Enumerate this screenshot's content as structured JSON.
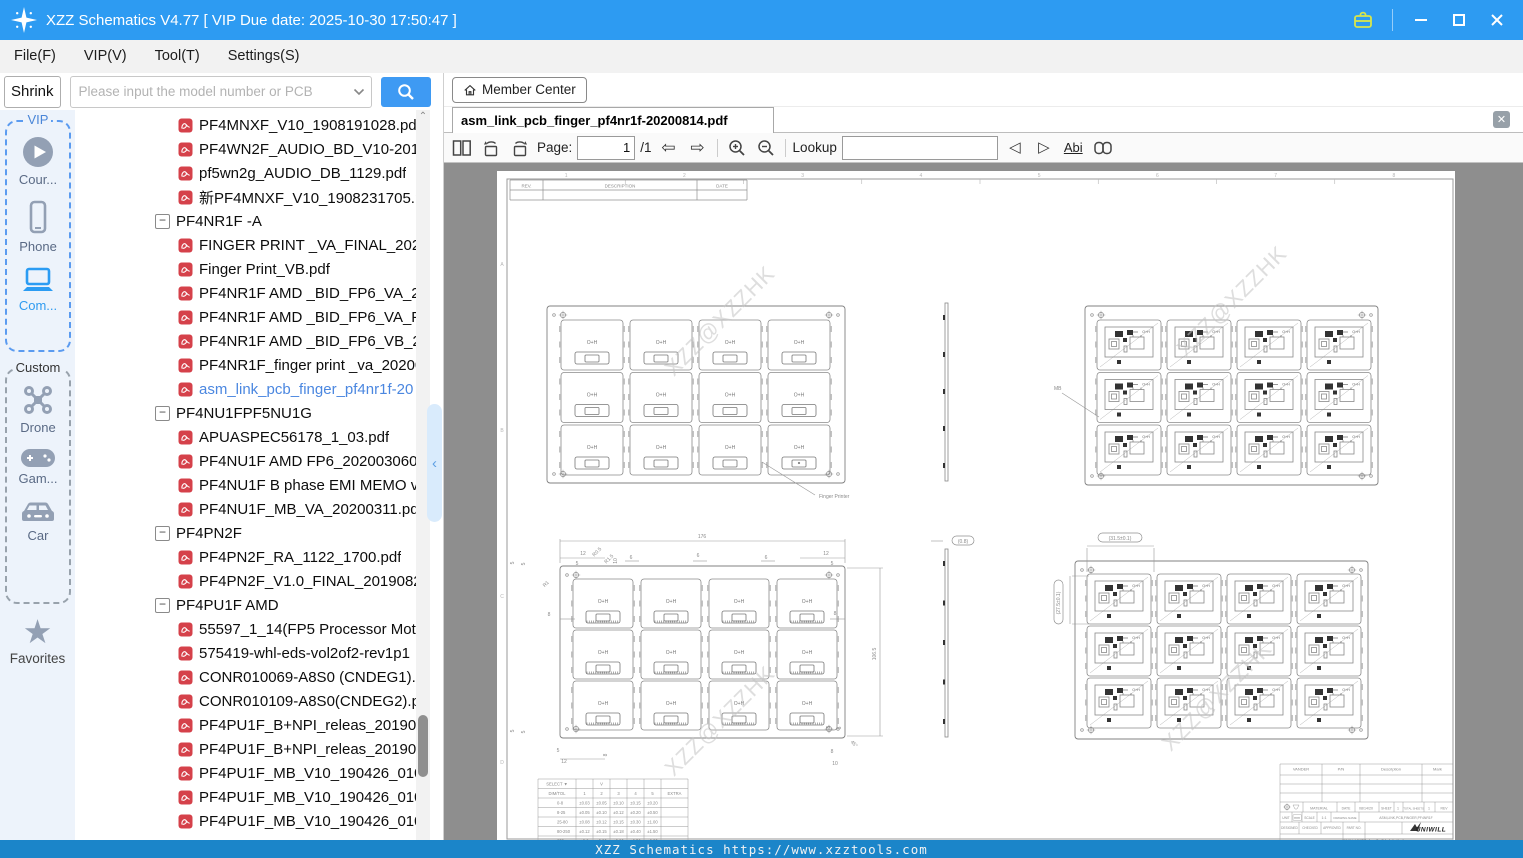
{
  "window": {
    "title": "XZZ Schematics V4.77 [ VIP Due date: 2025-10-30 17:50:47 ]"
  },
  "menu": [
    "File(F)",
    "VIP(V)",
    "Tool(T)",
    "Settings(S)"
  ],
  "search": {
    "shrink": "Shrink",
    "placeholder": "Please input the model number or PCB"
  },
  "member_center": {
    "label": "Member Center"
  },
  "sidebar": {
    "vip_label": "VIP",
    "custom_label": "Custom",
    "favorites_label": "Favorites",
    "items_vip": [
      "Cour...",
      "Phone",
      "Com..."
    ],
    "items_custom": [
      "Drone",
      "Gam...",
      "Car"
    ]
  },
  "tree": [
    {
      "t": "file",
      "l": "PF4MNXF_V10_1908191028.pdf"
    },
    {
      "t": "file",
      "l": "PF4WN2F_AUDIO_BD_V10-2019"
    },
    {
      "t": "file",
      "l": "pf5wn2g_AUDIO_DB_1129.pdf"
    },
    {
      "t": "file",
      "l": "新PF4MNXF_V10_1908231705.pc"
    },
    {
      "t": "folder",
      "l": "PF4NR1F -A"
    },
    {
      "t": "file",
      "l": "FINGER PRINT _VA_FINAL_20200"
    },
    {
      "t": "file",
      "l": "Finger Print_VB.pdf"
    },
    {
      "t": "file",
      "l": "PF4NR1F AMD _BID_FP6_VA_20."
    },
    {
      "t": "file",
      "l": "PF4NR1F AMD _BID_FP6_VA_FIN"
    },
    {
      "t": "file",
      "l": "PF4NR1F AMD _BID_FP6_VB_20."
    },
    {
      "t": "file",
      "l": "PF4NR1F_finger print _va_20200"
    },
    {
      "t": "file",
      "l": "asm_link_pcb_finger_pf4nr1f-20",
      "sel": true
    },
    {
      "t": "folder",
      "l": "PF4NU1FPF5NU1G"
    },
    {
      "t": "file",
      "l": "APUASPEC56178_1_03.pdf"
    },
    {
      "t": "file",
      "l": "PF4NU1F AMD FP6_2020030609"
    },
    {
      "t": "file",
      "l": "PF4NU1F B phase EMI MEMO v."
    },
    {
      "t": "file",
      "l": "PF4NU1F_MB_VA_20200311.pdf"
    },
    {
      "t": "folder",
      "l": "PF4PN2F"
    },
    {
      "t": "file",
      "l": "PF4PN2F_RA_1122_1700.pdf"
    },
    {
      "t": "file",
      "l": "PF4PN2F_V1.0_FINAL_20190828"
    },
    {
      "t": "folder",
      "l": "PF4PU1F AMD"
    },
    {
      "t": "file",
      "l": "55597_1_14(FP5 Processor Moth"
    },
    {
      "t": "file",
      "l": "575419-whl-eds-vol2of2-rev1p1"
    },
    {
      "t": "file",
      "l": "CONR010069-A8S0 (CNDEG1).p"
    },
    {
      "t": "file",
      "l": "CONR010109-A8S0(CNDEG2).pc"
    },
    {
      "t": "file",
      "l": "PF4PU1F_B+NPI_releas_2019062"
    },
    {
      "t": "file",
      "l": "PF4PU1F_B+NPI_releas_2019062"
    },
    {
      "t": "file",
      "l": "PF4PU1F_MB_V10_190426_0102"
    },
    {
      "t": "file",
      "l": "PF4PU1F_MB_V10_190426_0103"
    },
    {
      "t": "file",
      "l": "PF4PU1F_MB_V10_190426_0104"
    }
  ],
  "viewer": {
    "tab": "asm_link_pcb_finger_pf4nr1f-20200814.pdf",
    "page_label": "Page:",
    "page": "1",
    "of": "/1",
    "lookup_label": "Lookup",
    "abi_label": "Abi"
  },
  "status": {
    "text": "XZZ Schematics https://www.xzztools.com"
  },
  "drawing": {
    "watermark": "XZZ@XZZHK",
    "module_mark": "O+H",
    "rev_header": [
      "REV.",
      "DESCRIPTION",
      "DATE"
    ],
    "zone_numbers": [
      "1",
      "2",
      "3",
      "4",
      "5",
      "6",
      "7",
      "8"
    ],
    "zone_letters": [
      "A",
      "B",
      "C",
      "D"
    ],
    "panels": [
      {
        "type": "simple",
        "x": 50,
        "y": 135,
        "w": 298,
        "h": 177,
        "mw": 62,
        "mh": 50,
        "ox": 14,
        "oy": 14,
        "gx": 7,
        "gy": 2.5,
        "cols": 4,
        "rows": 3
      },
      {
        "type": "detail",
        "x": 588,
        "y": 135,
        "w": 293,
        "h": 179,
        "mw": 64,
        "mh": 50,
        "ox": 12,
        "oy": 14,
        "gx": 6,
        "gy": 2.5,
        "cols": 4,
        "rows": 3
      },
      {
        "type": "simple",
        "hatch": true,
        "x": 63,
        "y": 395,
        "w": 285,
        "h": 172,
        "mw": 60,
        "mh": 49,
        "ox": 13,
        "oy": 13,
        "gx": 8,
        "gy": 2,
        "cols": 4,
        "rows": 3
      },
      {
        "type": "detail",
        "x": 578,
        "y": 390,
        "w": 293,
        "h": 178,
        "mw": 64,
        "mh": 50,
        "ox": 12,
        "oy": 13,
        "gx": 6,
        "gy": 2,
        "cols": 4,
        "rows": 3
      }
    ],
    "strips": [
      {
        "x": 448,
        "y": 132,
        "h": 178
      },
      {
        "x": 448,
        "y": 378,
        "h": 188
      }
    ],
    "annotations": [
      {
        "t": "176",
        "x": 205,
        "y": 367
      },
      {
        "t": "106.5",
        "x": 379,
        "y": 483,
        "r": -90
      },
      {
        "t": "12",
        "x": 86,
        "y": 384
      },
      {
        "t": "5",
        "x": 80,
        "y": 394
      },
      {
        "t": "R0.5",
        "x": 101,
        "y": 382,
        "r": -45
      },
      {
        "t": "R1.5",
        "x": 113,
        "y": 389,
        "r": -45
      },
      {
        "t": "R1",
        "x": 50,
        "y": 414,
        "r": -45
      },
      {
        "t": "10",
        "x": 120,
        "y": 390,
        "r": -90
      },
      {
        "t": "6",
        "x": 134,
        "y": 388
      },
      {
        "t": "6",
        "x": 201,
        "y": 386
      },
      {
        "t": "6",
        "x": 269,
        "y": 388
      },
      {
        "t": "8",
        "x": 52,
        "y": 445
      },
      {
        "t": "8",
        "x": 338,
        "y": 444
      },
      {
        "t": "12",
        "x": 329,
        "y": 384
      },
      {
        "t": "5",
        "x": 335,
        "y": 394
      },
      {
        "t": "5",
        "x": 17,
        "y": 392,
        "r": -90
      },
      {
        "t": "5",
        "x": 28,
        "y": 393,
        "r": -90
      },
      {
        "t": "5",
        "x": 17,
        "y": 560,
        "r": -90
      },
      {
        "t": "5",
        "x": 28,
        "y": 561,
        "r": -90
      },
      {
        "t": "5",
        "x": 61,
        "y": 581
      },
      {
        "t": "12",
        "x": 67,
        "y": 592
      },
      {
        "t": "8",
        "x": 110,
        "y": 584,
        "r": -90
      },
      {
        "t": "5",
        "x": 333,
        "y": 556,
        "r": -90
      },
      {
        "t": "5",
        "x": 344,
        "y": 557,
        "r": -90
      },
      {
        "t": "8",
        "x": 335,
        "y": 582
      },
      {
        "t": "10",
        "x": 338,
        "y": 594
      },
      {
        "t": "45°",
        "x": 356,
        "y": 574,
        "r": 45
      },
      {
        "t": "Finger Printer",
        "x": 322,
        "y": 327,
        "a": "start"
      },
      {
        "t": "MB",
        "x": 557,
        "y": 219,
        "a": "start"
      },
      {
        "t": "(0.8)",
        "x": 466,
        "y": 371,
        "bubble": true,
        "bw": 22
      },
      {
        "t": "(31.5±0.1)",
        "x": 623,
        "y": 368,
        "bubble": true,
        "bw": 44
      },
      {
        "t": "(27.5±0.1)",
        "x": 563,
        "y": 431,
        "r": -90,
        "bubble": true,
        "bw": 44
      }
    ],
    "tol_table": {
      "select_label": "SELECT ▼",
      "v_mark": "V",
      "header": [
        "DIM/TOL",
        "1",
        "2",
        "3",
        "4",
        "5",
        "EXTRA"
      ],
      "rows": [
        [
          "0-8",
          "±0.03",
          "±0.05",
          "±0.10",
          "±0.15",
          "±0.20"
        ],
        [
          "8-25",
          "±0.05",
          "±0.10",
          "±0.12",
          "±0.20",
          "±0.50"
        ],
        [
          "25-80",
          "±0.08",
          "±0.12",
          "±0.15",
          "±0.30",
          "±1.00"
        ],
        [
          "80-250",
          "±0.12",
          "±0.15",
          "±0.18",
          "±0.40",
          "±1.50"
        ],
        [
          "250-",
          "±0.2",
          "±0.20",
          "±0.20",
          "±0.50",
          "±2.00"
        ]
      ]
    },
    "title_block": {
      "header": [
        "VANDER",
        "P/N",
        "Description",
        "Mark"
      ],
      "material": "MATERIAL",
      "date_label": "DATE",
      "date": "08/14/20",
      "sheet_label": "SHEET",
      "sheet": "1",
      "total_label": "TOTAL SHEETS",
      "total": "1",
      "rev_label": "REV",
      "unit_label": "UNIT",
      "unit": "mm",
      "scale_label": "SCALE",
      "scale": "1:1",
      "drawing_name_label": "DRAWING NAME",
      "drawing_name": "ASM,LINK,PCB,FINGER,PF4NR1F",
      "designed": "DESIGNED",
      "checked": "CHECKED",
      "approved": "APPROVED",
      "part_no": "PART NO.",
      "project_label": "PROJECT NAME",
      "project": "PF4NR1F",
      "company": "UNIWILL"
    }
  }
}
